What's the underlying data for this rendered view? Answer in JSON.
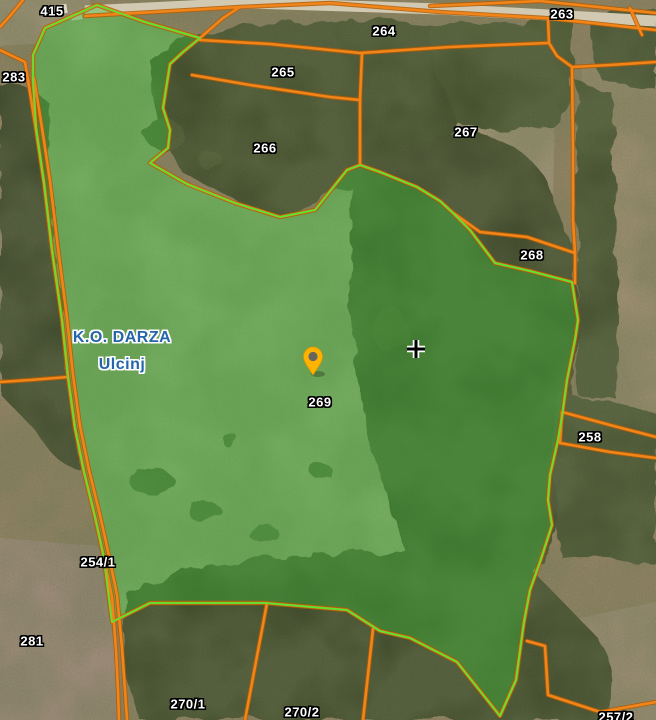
{
  "map": {
    "type": "cadastral-satellite-map",
    "selected_parcel_id": "269",
    "region_labels": [
      {
        "id": "cadastral-municipality",
        "text": "K.O. DARZA"
      },
      {
        "id": "municipality",
        "text": "Ulcinj"
      }
    ],
    "parcel_labels": [
      {
        "text": "415"
      },
      {
        "text": "283"
      },
      {
        "text": "264"
      },
      {
        "text": "263"
      },
      {
        "text": "265"
      },
      {
        "text": "266"
      },
      {
        "text": "267"
      },
      {
        "text": "268"
      },
      {
        "text": "269"
      },
      {
        "text": "258"
      },
      {
        "text": "254/1"
      },
      {
        "text": "281"
      },
      {
        "text": "270/1"
      },
      {
        "text": "270/2"
      },
      {
        "text": "257/2"
      }
    ],
    "icons": [
      {
        "name": "location-pin",
        "color": "#FFB300",
        "inner_color": "#66665f"
      },
      {
        "name": "crosshair-plus",
        "color": "#000000",
        "halo": "#FFFFFF"
      }
    ],
    "colors": {
      "parcel_boundary": "#F28519",
      "parcel_boundary_casing": "#B05C04",
      "selection_fill": "rgba(60,190,55,0.40)",
      "selection_outline": "#54E636",
      "parcel_label_text": "#FFFFFF",
      "parcel_label_halo": "#000000",
      "region_label_text": "#2465AB",
      "region_label_halo": "#FFFFFF"
    }
  }
}
